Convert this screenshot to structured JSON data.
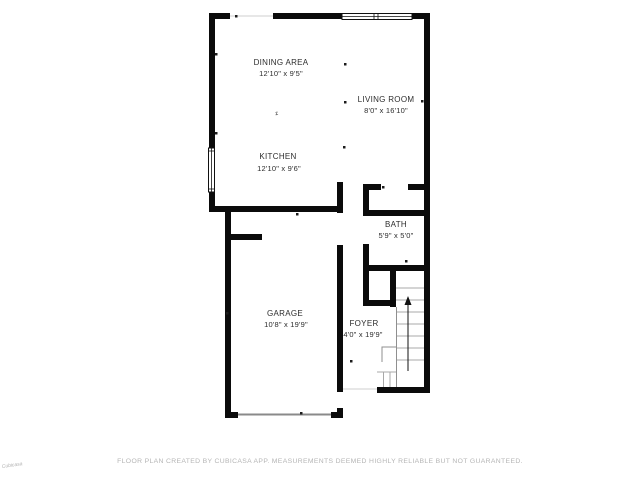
{
  "floor_plan": {
    "rooms": [
      {
        "name": "DINING AREA",
        "dimensions": "12'10\" x 9'5\""
      },
      {
        "name": "LIVING ROOM",
        "dimensions": "8'0\" x 16'10\""
      },
      {
        "name": "KITCHEN",
        "dimensions": "12'10\" x 9'6\""
      },
      {
        "name": "BATH",
        "dimensions": "5'9\" x 5'0\""
      },
      {
        "name": "GARAGE",
        "dimensions": "10'8\" x 19'9\""
      },
      {
        "name": "FOYER",
        "dimensions": "4'0\" x 19'9\""
      }
    ],
    "compass_marker": "z",
    "colors": {
      "wall": "#0b0b0b",
      "stair_lines": "#a8a8a8",
      "label_text": "#2d2d2d",
      "footer_text": "#b5b5b5"
    }
  },
  "footer": {
    "disclaimer": "FLOOR PLAN CREATED BY CUBICASA APP. MEASUREMENTS DEEMED HIGHLY RELIABLE BUT NOT GUARANTEED."
  },
  "watermark": {
    "text": "Cubicasa"
  }
}
